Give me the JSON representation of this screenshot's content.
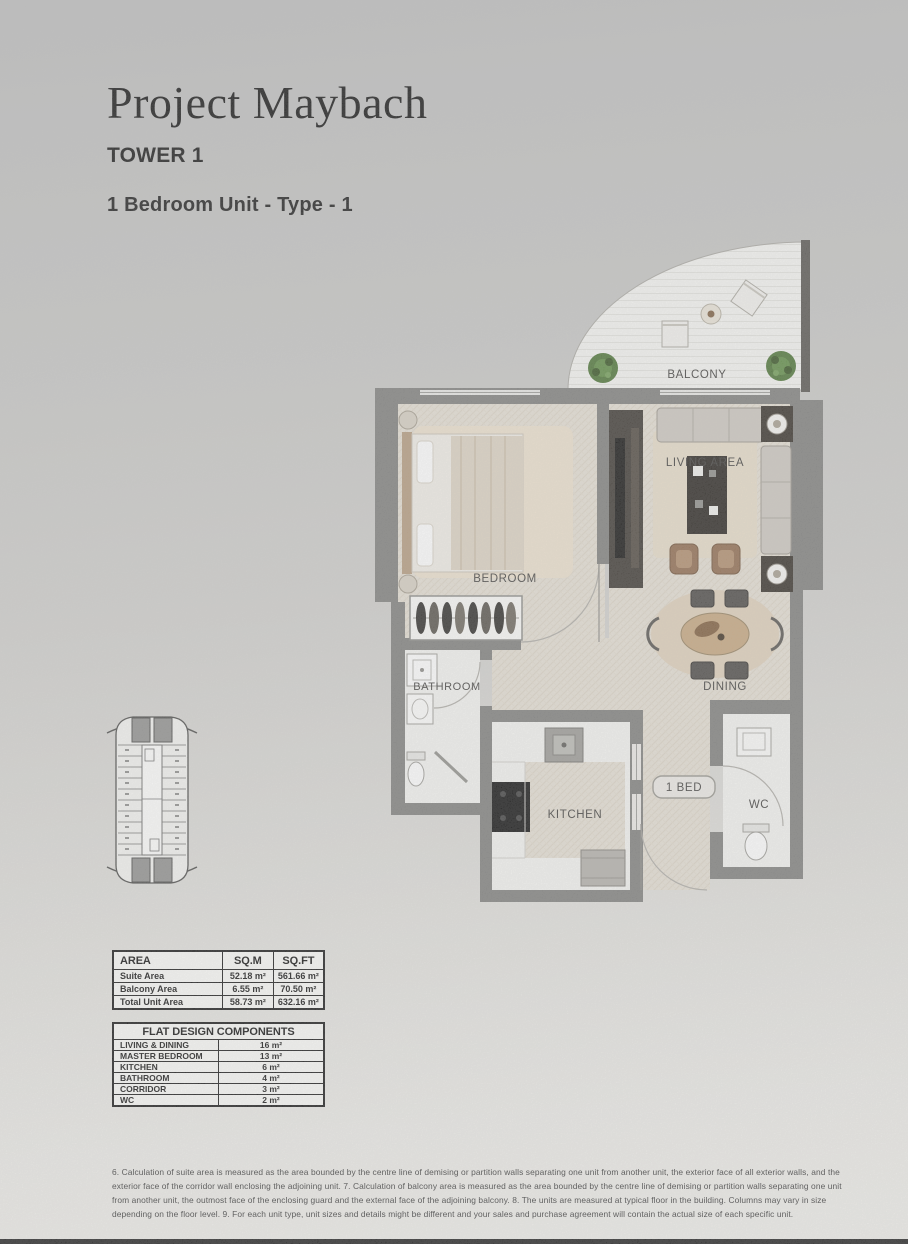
{
  "header": {
    "title": "Project Maybach",
    "tower": "TOWER 1",
    "unit": "1 Bedroom Unit - Type - 1"
  },
  "plan": {
    "balcony": "BALCONY",
    "living": "LIVING AREA",
    "bedroom": "BEDROOM",
    "bathroom": "BATHROOM",
    "dining": "DINING",
    "kitchen": "KITCHEN",
    "wc": "WC",
    "unit_tag": "1 BED"
  },
  "area_table": {
    "headers": {
      "area": "AREA",
      "sqm": "SQ.M",
      "sqft": "SQ.FT"
    },
    "rows": [
      {
        "label": "Suite Area",
        "sqm": "52.18 m²",
        "sqft": "561.66 m²"
      },
      {
        "label": "Balcony Area",
        "sqm": "6.55 m²",
        "sqft": "70.50 m²"
      },
      {
        "label": "Total Unit Area",
        "sqm": "58.73 m²",
        "sqft": "632.16 m²"
      }
    ]
  },
  "components_table": {
    "title": "FLAT DESIGN COMPONENTS",
    "rows": [
      {
        "label": "LIVING & DINING",
        "value": "16 m²"
      },
      {
        "label": "MASTER BEDROOM",
        "value": "13 m²"
      },
      {
        "label": "KITCHEN",
        "value": "6 m²"
      },
      {
        "label": "BATHROOM",
        "value": "4 m²"
      },
      {
        "label": "CORRIDOR",
        "value": "3 m²"
      },
      {
        "label": "WC",
        "value": "2 m²"
      }
    ]
  },
  "disclaimer": "6. Calculation of suite area is measured as the area bounded by the centre line of demising or partition walls separating one unit from another unit, the exterior face of all exterior walls, and the exterior face of the corridor wall enclosing the adjoining unit.   7. Calculation of balcony area is measured as the area bounded by the centre line of demising or partition walls separating one unit from another unit, the outmost face of the enclosing guard and the external face of the adjoining balcony.   8. The units are measured at typical floor in the building. Columns may vary in size depending on the floor level.   9. For each unit type, unit sizes and details might be different and your sales and purchase agreement will contain the actual size of each specific unit.",
  "colors": {
    "wall": "#7d7d7b",
    "floor": "#e5dfd4",
    "room_white": "#f4f4f1",
    "plant": "#4a7233",
    "cabinet_dark": "#39342e"
  }
}
